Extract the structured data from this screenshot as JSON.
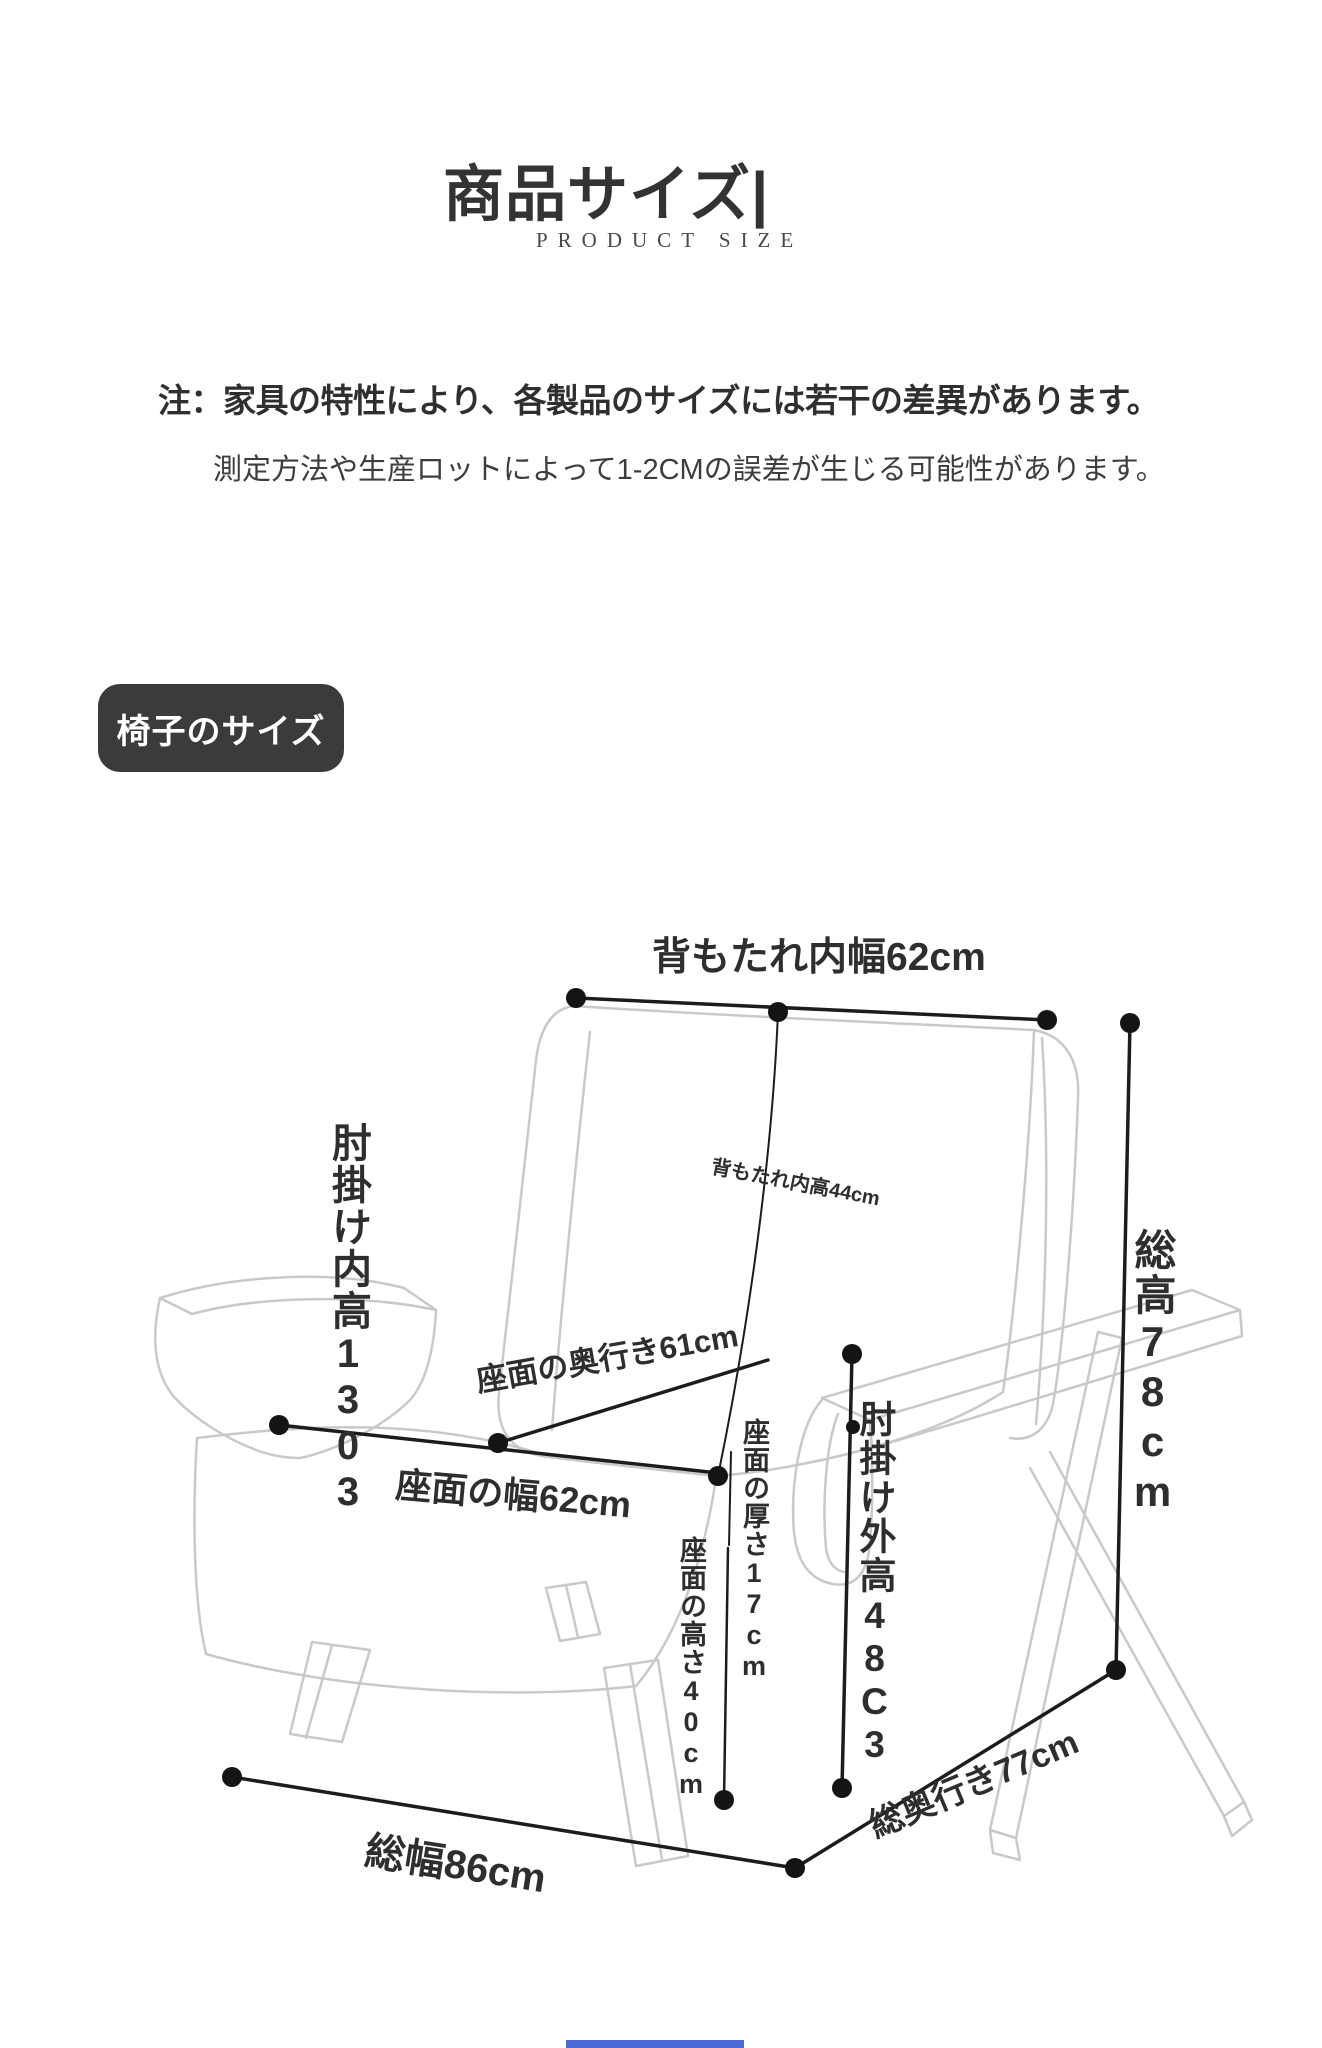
{
  "header": {
    "title": "商品サイズ|",
    "subtitle": "PRODUCT SIZE"
  },
  "notice": {
    "line1": "注：家具の特性により、各製品のサイズには若干の差異があります。",
    "line2": "測定方法や生産ロットによって1-2CMの誤差が生じる可能性があります。"
  },
  "badge": {
    "label": "椅子のサイズ"
  },
  "diagram": {
    "labels": {
      "backrest_inner_width": "背もたれ内幅62cm",
      "backrest_inner_height": "背もたれ内高44cm",
      "armrest_inner_height": "肘掛け内高1303",
      "seat_depth": "座面の奥行き61cm",
      "seat_width": "座面の幅62cm",
      "seat_thickness": "座面の厚さ17cm",
      "seat_height": "座面の高さ40cm",
      "armrest_outer_height": "肘掛け外高48C3",
      "total_height": "総高78cm",
      "total_width": "総幅86cm",
      "total_depth": "総奥行き77cm"
    },
    "colors": {
      "measure_line": "#1c1c1c",
      "chair_line": "#c9c9c9",
      "label_text": "#2e2e2e",
      "badge_bg": "#3b3b3b",
      "footer_accent": "#4a6bd3"
    }
  }
}
